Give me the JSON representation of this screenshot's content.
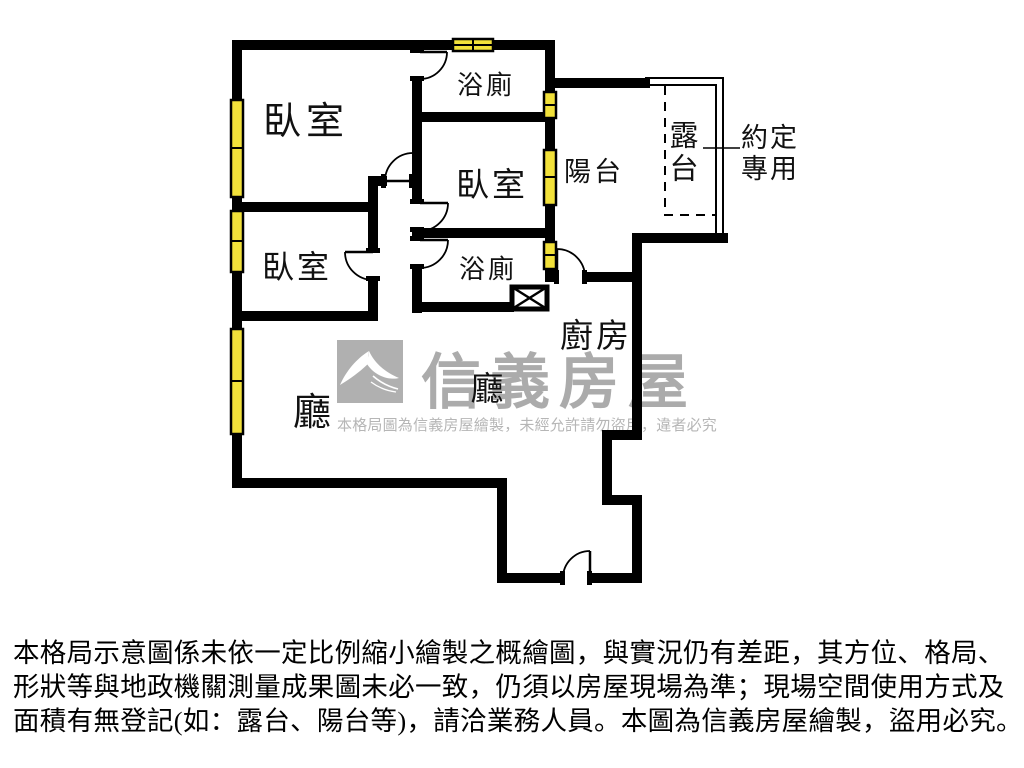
{
  "floorplan": {
    "colors": {
      "wall": "#000000",
      "window_fill": "#f2e13a",
      "watermark_gray": "#ababab",
      "notice_gray": "#b6b6b6",
      "label_text": "#111111"
    },
    "labels": {
      "bedroom_top_left": "臥室",
      "bathroom_top": "浴廁",
      "bedroom_middle": "臥室",
      "balcony": "陽台",
      "terrace": "露台",
      "agreed_use_line1": "約定",
      "agreed_use_line2": "專用",
      "bedroom_lower_left": "臥室",
      "bathroom_lower": "浴廁",
      "kitchen": "廚房",
      "dining_hall": "廳",
      "living_hall": "廳"
    }
  },
  "watermark": {
    "brand": "信義房屋",
    "notice": "本格局圖為信義房屋繪製，未經允許請勿盜用，違者必究"
  },
  "disclaimer": {
    "line1": "本格局示意圖係未依一定比例縮小繪製之概繪圖，與實況仍有差距，其方位、格局、",
    "line2": "形狀等與地政機關測量成果圖未必一致，仍須以房屋現場為準；現場空間使用方式及",
    "line3": "面積有無登記(如：露台、陽台等)，請洽業務人員。本圖為信義房屋繪製，盜用必究。"
  }
}
